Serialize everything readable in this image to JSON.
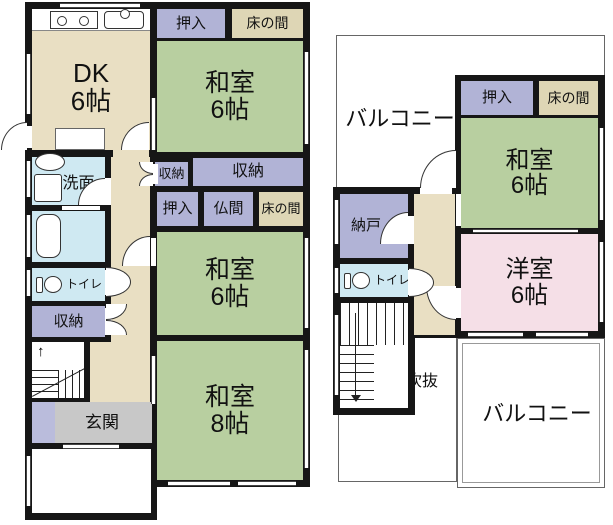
{
  "title": "madori-floor-plan",
  "colors": {
    "wall": "#161616",
    "beige": "#e9dfc3",
    "tokonoma": "#ded6b5",
    "tatami": "#b8cfa0",
    "purple": "#b1b3d6",
    "purple2": "#babcdc",
    "blue": "#cfe9f2",
    "gray": "#c8c8c8",
    "pink": "#f5dfe7",
    "white": "#ffffff",
    "open_border": "#666666"
  },
  "floors": [
    {
      "name": "floor-plan-1f",
      "open_areas": [],
      "walls": [
        {
          "x": 25,
          "y": 2,
          "w": 132,
          "h": 518
        },
        {
          "x": 150,
          "y": 2,
          "w": 160,
          "h": 485
        }
      ],
      "rooms": [
        {
          "name": "room-dk",
          "label": [
            "DK",
            "6帖"
          ],
          "fs": 26,
          "fill": "beige",
          "x": 32,
          "y": 9,
          "w": 118,
          "h": 141,
          "ldy": 8
        },
        {
          "name": "room-corridor-dk-patch",
          "label": [],
          "fill": "beige",
          "x": 113,
          "y": 150,
          "w": 36,
          "h": 7
        },
        {
          "name": "room-oshiire-1f-top",
          "label": [
            "押入"
          ],
          "fs": 15,
          "fill": "purple",
          "x": 157,
          "y": 9,
          "w": 68,
          "h": 29
        },
        {
          "name": "room-tokonoma-1f-top",
          "label": [
            "床の間"
          ],
          "fs": 14,
          "fill": "tokonoma",
          "x": 232,
          "y": 9,
          "w": 71,
          "h": 29
        },
        {
          "name": "room-washitsu-1f-top",
          "label": [
            "和室",
            "6帖"
          ],
          "fs": 25,
          "fill": "tatami",
          "tatami": 6,
          "x": 157,
          "y": 41,
          "w": 146,
          "h": 111
        },
        {
          "name": "room-senmen",
          "label": [
            "洗面"
          ],
          "fs": 16,
          "fill": "blue",
          "x": 32,
          "y": 157,
          "w": 73,
          "h": 48,
          "ldx": 10,
          "ldy": 3
        },
        {
          "name": "room-bath",
          "label": [],
          "fill": "blue",
          "x": 32,
          "y": 211,
          "w": 73,
          "h": 51
        },
        {
          "name": "room-toilet-1f",
          "label": [
            "トイレ"
          ],
          "fs": 12,
          "fill": "blue",
          "toilet": true,
          "x": 32,
          "y": 268,
          "w": 73,
          "h": 33
        },
        {
          "name": "room-shuno-left",
          "label": [
            "収納"
          ],
          "fs": 15,
          "fill": "purple",
          "x": 32,
          "y": 306,
          "w": 73,
          "h": 31
        },
        {
          "name": "room-corridor-1f",
          "label": [],
          "fill": "beige",
          "x": 111,
          "y": 157,
          "w": 39,
          "h": 245
        },
        {
          "name": "room-corridor-1f-lower",
          "label": [],
          "fill": "beige",
          "x": 90,
          "y": 342,
          "w": 60,
          "h": 60
        },
        {
          "name": "room-genkan",
          "label": [
            "玄関"
          ],
          "fs": 17,
          "fill": "gray",
          "x": 32,
          "y": 402,
          "w": 120,
          "h": 41,
          "ldx": 10
        },
        {
          "name": "room-genkan-strip",
          "label": [],
          "fill": "purple2",
          "x": 32,
          "y": 402,
          "w": 23,
          "h": 41
        },
        {
          "name": "room-porch",
          "label": [],
          "fill": "white",
          "x": 32,
          "y": 449,
          "w": 119,
          "h": 64
        },
        {
          "name": "room-shuno-small",
          "label": [
            "収納"
          ],
          "fs": 13,
          "fill": "purple",
          "x": 155,
          "y": 162,
          "w": 33,
          "h": 24
        },
        {
          "name": "room-shuno-large",
          "label": [
            "収納"
          ],
          "fs": 16,
          "fill": "purple",
          "x": 193,
          "y": 158,
          "w": 110,
          "h": 28
        },
        {
          "name": "room-oshiire-1f-mid",
          "label": [
            "押入"
          ],
          "fs": 15,
          "fill": "purple",
          "x": 157,
          "y": 192,
          "w": 41,
          "h": 34
        },
        {
          "name": "room-butsuma",
          "label": [
            "仏間"
          ],
          "fs": 15,
          "fill": "purple",
          "x": 204,
          "y": 192,
          "w": 49,
          "h": 34
        },
        {
          "name": "room-tokonoma-1f-mid",
          "label": [
            "床の間"
          ],
          "fs": 13,
          "fill": "tokonoma",
          "x": 259,
          "y": 192,
          "w": 44,
          "h": 34
        },
        {
          "name": "room-washitsu-1f-mid",
          "label": [
            "和室",
            "6帖"
          ],
          "fs": 25,
          "fill": "tatami",
          "tatami": 6,
          "x": 157,
          "y": 232,
          "w": 146,
          "h": 103
        },
        {
          "name": "room-washitsu-8",
          "label": [
            "和室",
            "8帖"
          ],
          "fs": 25,
          "fill": "tatami",
          "tatami": 8,
          "x": 157,
          "y": 341,
          "w": 146,
          "h": 139
        }
      ],
      "features": [
        {
          "t": "kitchen",
          "n": "kitchen-counter-strip",
          "x": 32,
          "y": 9,
          "w": 118,
          "h": 22
        },
        {
          "t": "stove",
          "n": "stove-icon",
          "x": 50,
          "y": 11,
          "w": 48,
          "h": 18
        },
        {
          "t": "sink",
          "n": "kitchen-sink-icon",
          "x": 104,
          "y": 11,
          "w": 40,
          "h": 18
        },
        {
          "t": "counter",
          "n": "dk-counter",
          "x": 55,
          "y": 128,
          "w": 50,
          "h": 22
        },
        {
          "t": "basin",
          "n": "washbasin-icon",
          "x": 35,
          "y": 153,
          "w": 30,
          "h": 18
        },
        {
          "t": "washer",
          "n": "washer-icon",
          "x": 34,
          "y": 174,
          "w": 28,
          "h": 28
        },
        {
          "t": "bathtub",
          "n": "bathtub-icon",
          "x": 36,
          "y": 214,
          "w": 25,
          "h": 44
        },
        {
          "t": "stairs1",
          "n": "staircase-1f",
          "x": 32,
          "y": 342,
          "w": 52,
          "h": 56
        },
        {
          "t": "wgap",
          "n": "opening-backdoor",
          "x": 26,
          "y": 126,
          "w": 6,
          "h": 22
        },
        {
          "t": "wgap",
          "n": "opening-senmen-door",
          "x": 105,
          "y": 178,
          "w": 6,
          "h": 27
        },
        {
          "t": "wgap",
          "n": "opening-senmen-bath",
          "x": 62,
          "y": 206,
          "w": 38,
          "h": 4
        },
        {
          "t": "wgap",
          "n": "opening-toilet-1f",
          "x": 105,
          "y": 270,
          "w": 7,
          "h": 25
        },
        {
          "t": "wgap",
          "n": "opening-shuno-left",
          "x": 105,
          "y": 308,
          "w": 7,
          "h": 27
        },
        {
          "t": "wgap",
          "n": "opening-shuno-small",
          "x": 150,
          "y": 164,
          "w": 8,
          "h": 20
        },
        {
          "t": "wgap",
          "n": "opening-washitsu-mid",
          "x": 151,
          "y": 238,
          "w": 5,
          "h": 28
        },
        {
          "t": "arc",
          "q": "tl",
          "n": "door-arc-backdoor",
          "x": 1,
          "y": 122,
          "w": 26,
          "h": 28
        },
        {
          "t": "arc",
          "q": "tl",
          "n": "door-arc-dk",
          "x": 121,
          "y": 122,
          "w": 28,
          "h": 28
        },
        {
          "t": "arc",
          "q": "tl",
          "n": "door-arc-senmen",
          "x": 78,
          "y": 178,
          "w": 27,
          "h": 27
        },
        {
          "t": "arc",
          "q": "tl",
          "n": "door-arc-washitsu-mid",
          "x": 122,
          "y": 236,
          "w": 28,
          "h": 30
        },
        {
          "t": "semi",
          "n": "door-toilet-1f",
          "x": 106,
          "y": 267,
          "w": 25,
          "h": 30
        },
        {
          "t": "bifold",
          "dir": "l",
          "n": "bifold-shuno-small",
          "x": 139,
          "y": 162,
          "w": 14,
          "h": 24
        },
        {
          "t": "bifold",
          "dir": "r",
          "n": "bifold-shuno-left",
          "x": 106,
          "y": 304,
          "w": 21,
          "h": 31
        },
        {
          "t": "vwin",
          "n": "window-dk-left",
          "x": 26,
          "y": 54,
          "w": 5,
          "h": 60
        },
        {
          "t": "vwin",
          "n": "window-senmen-left",
          "x": 26,
          "y": 161,
          "w": 5,
          "h": 36
        },
        {
          "t": "vwin",
          "n": "window-bath-left",
          "x": 26,
          "y": 215,
          "w": 5,
          "h": 42
        },
        {
          "t": "vwin",
          "n": "window-toilet-left",
          "x": 26,
          "y": 270,
          "w": 5,
          "h": 26
        },
        {
          "t": "vwin",
          "n": "window-porch-left",
          "x": 26,
          "y": 456,
          "w": 5,
          "h": 50
        },
        {
          "t": "hwin",
          "n": "window-kitchen-top",
          "x": 60,
          "y": 3,
          "w": 80,
          "h": 5
        },
        {
          "t": "vwin",
          "n": "window-washitsu-top-right",
          "x": 304,
          "y": 52,
          "w": 5,
          "h": 92
        },
        {
          "t": "vwin",
          "n": "window-washitsu-mid-right",
          "x": 304,
          "y": 238,
          "w": 5,
          "h": 90
        },
        {
          "t": "vwin",
          "n": "window-washitsu8-right",
          "x": 304,
          "y": 350,
          "w": 5,
          "h": 118
        },
        {
          "t": "hwin",
          "n": "window-washitsu8-bottom-1",
          "x": 168,
          "y": 481,
          "w": 62,
          "h": 5
        },
        {
          "t": "hwin",
          "n": "window-washitsu8-bottom-2",
          "x": 238,
          "y": 481,
          "w": 58,
          "h": 5
        },
        {
          "t": "vwin",
          "n": "sliding-dk-washitsu",
          "x": 151,
          "y": 98,
          "w": 5,
          "h": 52
        },
        {
          "t": "vwin",
          "n": "sliding-corr-washitsu8",
          "x": 151,
          "y": 356,
          "w": 5,
          "h": 48
        },
        {
          "t": "hwin",
          "n": "entrance-door",
          "x": 63,
          "y": 444,
          "w": 56,
          "h": 5
        }
      ]
    },
    {
      "name": "floor-plan-2f",
      "open_areas": [
        {
          "name": "balcony-top",
          "label": [
            "バルコニー"
          ],
          "fs": 22,
          "x": 336,
          "y": 35,
          "w": 269,
          "h": 155,
          "label_at": {
            "x": 399,
            "y": 116
          }
        },
        {
          "name": "fukinuke-void",
          "label": [
            "吹抜"
          ],
          "fs": 16,
          "x": 338,
          "y": 335,
          "w": 119,
          "h": 147,
          "label_at": {
            "x": 421,
            "y": 378
          }
        },
        {
          "name": "balcony-bottom",
          "label": [
            "バルコニー"
          ],
          "fs": 22,
          "x": 457,
          "y": 338,
          "w": 148,
          "h": 150,
          "label_at": {
            "x": 536,
            "y": 411
          },
          "double": true
        }
      ],
      "walls": [
        {
          "x": 455,
          "y": 75,
          "w": 150,
          "h": 263
        },
        {
          "x": 333,
          "y": 187,
          "w": 127,
          "h": 151
        },
        {
          "x": 333,
          "y": 297,
          "w": 82,
          "h": 118
        }
      ],
      "rooms": [
        {
          "name": "room-nando",
          "label": [
            "納戸"
          ],
          "fs": 15,
          "fill": "purple",
          "x": 340,
          "y": 194,
          "w": 68,
          "h": 64,
          "ldx": -8
        },
        {
          "name": "room-toilet-2f",
          "label": [
            "トイレ"
          ],
          "fs": 12,
          "fill": "blue",
          "toilet": true,
          "x": 340,
          "y": 264,
          "w": 68,
          "h": 33
        },
        {
          "name": "room-corridor-2f",
          "label": [],
          "fill": "beige",
          "x": 414,
          "y": 194,
          "w": 41,
          "h": 141
        },
        {
          "name": "room-oshiire-2f",
          "label": [
            "押入"
          ],
          "fs": 15,
          "fill": "purple",
          "x": 461,
          "y": 81,
          "w": 72,
          "h": 34
        },
        {
          "name": "room-tokonoma-2f",
          "label": [
            "床の間"
          ],
          "fs": 14,
          "fill": "tokonoma",
          "x": 539,
          "y": 81,
          "w": 59,
          "h": 34
        },
        {
          "name": "room-washitsu-2f",
          "label": [
            "和室",
            "6帖"
          ],
          "fs": 24,
          "fill": "tatami",
          "tatami": 6,
          "x": 461,
          "y": 118,
          "w": 137,
          "h": 110
        },
        {
          "name": "room-yoshitsu",
          "label": [
            "洋室",
            "6帖"
          ],
          "fs": 24,
          "fill": "pink",
          "x": 461,
          "y": 234,
          "w": 137,
          "h": 97
        }
      ],
      "features": [
        {
          "t": "stairs2",
          "n": "staircase-2f",
          "x": 340,
          "y": 303,
          "w": 68,
          "h": 105
        },
        {
          "t": "wgap",
          "n": "opening-balcony",
          "x": 420,
          "y": 188,
          "w": 32,
          "h": 6
        },
        {
          "t": "wgap",
          "n": "opening-nando",
          "x": 408,
          "y": 216,
          "w": 6,
          "h": 28
        },
        {
          "t": "wgap",
          "n": "opening-toilet-2f",
          "x": 408,
          "y": 270,
          "w": 6,
          "h": 25
        },
        {
          "t": "wgap",
          "n": "opening-yoshitsu",
          "x": 456,
          "y": 288,
          "w": 5,
          "h": 30
        },
        {
          "t": "wgap",
          "n": "opening-corr-washitsu-2f",
          "x": 456,
          "y": 194,
          "w": 5,
          "h": 32
        },
        {
          "t": "arc",
          "q": "tl",
          "n": "door-arc-balcony",
          "x": 420,
          "y": 150,
          "w": 36,
          "h": 38
        },
        {
          "t": "arc",
          "q": "tl",
          "n": "door-arc-nando",
          "x": 380,
          "y": 212,
          "w": 28,
          "h": 32
        },
        {
          "t": "arc",
          "q": "bl",
          "n": "door-arc-yoshitsu",
          "x": 426,
          "y": 286,
          "w": 30,
          "h": 34
        },
        {
          "t": "semi",
          "n": "door-toilet-2f",
          "x": 409,
          "y": 268,
          "w": 25,
          "h": 29
        },
        {
          "t": "vwin",
          "n": "window-nando-left",
          "x": 334,
          "y": 200,
          "w": 5,
          "h": 44
        },
        {
          "t": "vwin",
          "n": "window-toilet-2f-left",
          "x": 334,
          "y": 268,
          "w": 5,
          "h": 25
        },
        {
          "t": "vwin",
          "n": "window-stairs-left",
          "x": 334,
          "y": 315,
          "w": 5,
          "h": 80
        },
        {
          "t": "vwin",
          "n": "window-washitsu-2f-right",
          "x": 599,
          "y": 128,
          "w": 5,
          "h": 92
        },
        {
          "t": "vwin",
          "n": "window-yoshitsu-right",
          "x": 599,
          "y": 242,
          "w": 5,
          "h": 80
        },
        {
          "t": "hwin",
          "n": "window-yoshitsu-bottom-1",
          "x": 468,
          "y": 332,
          "w": 55,
          "h": 5
        },
        {
          "t": "hwin",
          "n": "window-yoshitsu-bottom-2",
          "x": 536,
          "y": 332,
          "w": 52,
          "h": 5
        },
        {
          "t": "hwin",
          "n": "sliding-washitsu-yoshitsu",
          "x": 473,
          "y": 229,
          "w": 105,
          "h": 4
        }
      ]
    }
  ]
}
